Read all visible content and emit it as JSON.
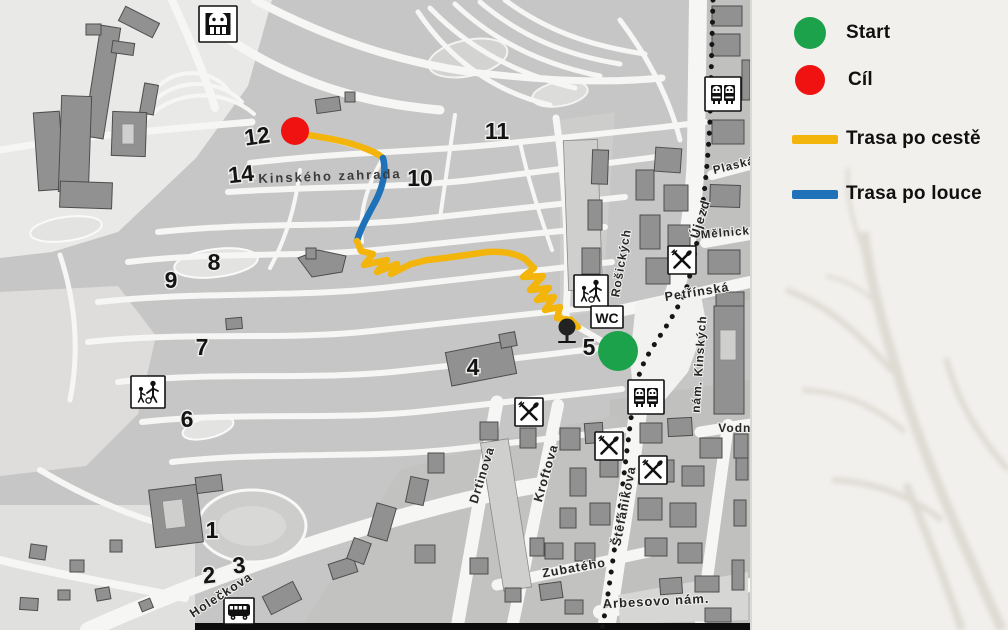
{
  "legend": {
    "items": [
      {
        "id": "start",
        "swatch": "circle",
        "color": "#1ca24b",
        "label": "Start"
      },
      {
        "id": "cil",
        "swatch": "circle",
        "color": "#f01111",
        "label": "Cíl"
      },
      {
        "id": "trasa-po-ceste",
        "swatch": "line",
        "color": "#f3b50c",
        "label": "Trasa po cestě"
      },
      {
        "id": "trasa-po-louce",
        "swatch": "line",
        "color": "#1f72b8",
        "label": "Trasa po louce"
      }
    ]
  },
  "map": {
    "park_label": {
      "text": "Kinského zahrada",
      "x": 330,
      "y": 176,
      "rot": -2,
      "size": 13
    },
    "markers": {
      "start": {
        "x": 618,
        "y": 351,
        "r": 20,
        "color": "#1ca24b"
      },
      "cil": {
        "x": 295,
        "y": 131,
        "r": 14,
        "color": "#f01111"
      }
    },
    "route_segments": [
      {
        "name": "trasa-po-ceste-1",
        "color": "#f3b50c",
        "d": "M 296,133 C 315,136 335,139 352,144 C 365,148 376,152 383,158"
      },
      {
        "name": "trasa-po-louce",
        "color": "#1f72b8",
        "d": "M 383,158 C 387,172 382,190 374,204 C 367,217 360,230 357,241"
      },
      {
        "name": "trasa-po-ceste-2",
        "color": "#f3b50c",
        "d": "M 357,241 L 361,251 L 373,254 L 364,265 L 387,260 L 377,272 L 397,264 L 391,274 L 411,264 L 427,260 C 447,258 467,255 487,252 C 502,251 515,253 525,259 L 534,268 L 523,277 L 543,276 L 530,290 L 549,288 L 537,300 L 554,297 L 545,310 L 560,307 L 557,318 L 571,320 L 578,327"
      }
    ],
    "numbers": [
      {
        "n": "1",
        "x": 212,
        "y": 530,
        "rot": 0
      },
      {
        "n": "2",
        "x": 209,
        "y": 575,
        "rot": -6
      },
      {
        "n": "3",
        "x": 239,
        "y": 565,
        "rot": -6
      },
      {
        "n": "4",
        "x": 473,
        "y": 367,
        "rot": 0
      },
      {
        "n": "5",
        "x": 589,
        "y": 347,
        "rot": 0
      },
      {
        "n": "6",
        "x": 187,
        "y": 419,
        "rot": 0
      },
      {
        "n": "7",
        "x": 202,
        "y": 347,
        "rot": 0
      },
      {
        "n": "8",
        "x": 214,
        "y": 262,
        "rot": 0
      },
      {
        "n": "9",
        "x": 171,
        "y": 280,
        "rot": 0
      },
      {
        "n": "10",
        "x": 420,
        "y": 178,
        "rot": 0
      },
      {
        "n": "11",
        "x": 497,
        "y": 131,
        "rot": 0
      },
      {
        "n": "12",
        "x": 257,
        "y": 136,
        "rot": -8
      },
      {
        "n": "14",
        "x": 241,
        "y": 174,
        "rot": -6
      }
    ],
    "streets": [
      {
        "text": "Holečkova",
        "x": 221,
        "y": 595,
        "rot": -33,
        "size": 12.5
      },
      {
        "text": "Drtinova",
        "x": 482,
        "y": 475,
        "rot": -73,
        "size": 12.5
      },
      {
        "text": "Kroftova",
        "x": 546,
        "y": 473,
        "rot": -74,
        "size": 12.5
      },
      {
        "text": "Štefánikova",
        "x": 624,
        "y": 506,
        "rot": -79,
        "size": 12.5
      },
      {
        "text": "Zubatého",
        "x": 574,
        "y": 568,
        "rot": -10,
        "size": 12.5
      },
      {
        "text": "Arbesovo nám.",
        "x": 656,
        "y": 601,
        "rot": -3,
        "size": 13
      },
      {
        "text": "Rošických",
        "x": 621,
        "y": 263,
        "rot": -80,
        "size": 12
      },
      {
        "text": "Petřínská",
        "x": 697,
        "y": 292,
        "rot": -9,
        "size": 12.5
      },
      {
        "text": "Újezd",
        "x": 700,
        "y": 219,
        "rot": -73,
        "size": 13
      },
      {
        "text": "nám. Kinských",
        "x": 699,
        "y": 364,
        "rot": -86,
        "size": 12
      },
      {
        "text": "Vodní",
        "x": 737,
        "y": 428,
        "rot": 0,
        "size": 12
      },
      {
        "text": "Plaská",
        "x": 734,
        "y": 166,
        "rot": -14,
        "size": 11.5
      },
      {
        "text": "Mělnická",
        "x": 729,
        "y": 233,
        "rot": -5,
        "size": 11.5
      }
    ],
    "icons": [
      {
        "type": "funicular",
        "x": 218,
        "y": 24
      },
      {
        "type": "playground",
        "x": 148,
        "y": 392
      },
      {
        "type": "playground",
        "x": 591,
        "y": 291
      },
      {
        "type": "wc",
        "x": 607,
        "y": 317
      },
      {
        "type": "tree",
        "x": 567,
        "y": 331
      },
      {
        "type": "restaurant",
        "x": 529,
        "y": 412
      },
      {
        "type": "restaurant",
        "x": 609,
        "y": 446
      },
      {
        "type": "restaurant",
        "x": 653,
        "y": 470
      },
      {
        "type": "restaurant",
        "x": 682,
        "y": 260
      },
      {
        "type": "tram",
        "x": 646,
        "y": 397
      },
      {
        "type": "tram",
        "x": 723,
        "y": 94
      },
      {
        "type": "bus",
        "x": 239,
        "y": 611
      }
    ]
  }
}
